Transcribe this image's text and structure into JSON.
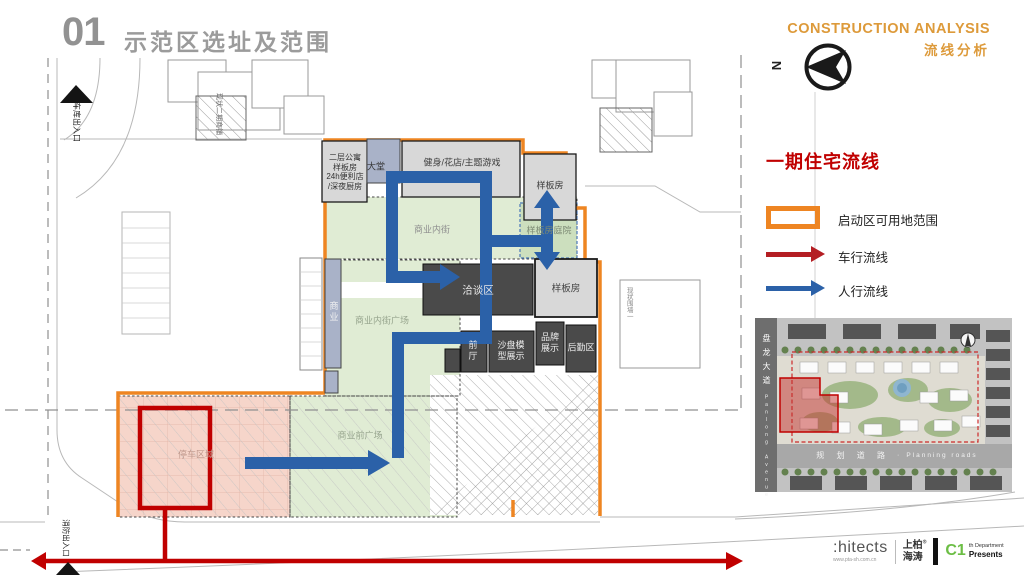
{
  "slide": {
    "number": "01",
    "title": "示范区选址及范围"
  },
  "header": {
    "en_title": "CONSTRUCTION ANALYSIS",
    "cn_subtitle": "流线分析",
    "compass_n": "N"
  },
  "legend": {
    "title": "一期住宅流线",
    "items": [
      {
        "label": "启动区可用地范围"
      },
      {
        "label": "车行流线"
      },
      {
        "label": "人行流线"
      }
    ]
  },
  "plan": {
    "buildings": {
      "apartment_block": "二层公寓\n样板房\n24h便利店\n/深夜厨房",
      "lobby": "大堂",
      "gym": "健身/花店/主题游戏",
      "sample_room_top": "样板房",
      "sample_courtyard": "样板房庭院",
      "sample_room_right": "样板房",
      "negotiation": "洽谈区",
      "front_hall": "前\n厅",
      "sand_table": "沙盘模\n型展示",
      "brand_display": "品牌\n展示",
      "logistics": "后勤区",
      "commerce": "商业"
    },
    "areas": {
      "inner_street": "商业内街",
      "inner_street_plaza": "商业内街广场",
      "front_plaza": "商业前广场",
      "parking": "停车区域"
    },
    "annotations": {
      "garage_entrance": "车库出入口",
      "fire_entrance": "消防出入口",
      "neighbor_building": "现状二期商铺",
      "fence_note": "现状围墙一"
    }
  },
  "minimap": {
    "road_left_cn": "盘龙大道",
    "road_left_en": "Panlong Avenue",
    "road_bottom_cn": "规 划 道 路",
    "separator": "·",
    "road_bottom_en": "Planning roads"
  },
  "footer": {
    "logo_text": ":hitects",
    "logo_url": "www.pta-sh.com.cn",
    "brand_top": "上柏",
    "brand_bottom": "海涛",
    "reg": "®",
    "dept_code": "C1",
    "dept_sup": "th",
    "dept_word": "Department",
    "presents": "Presents"
  },
  "colors": {
    "accent_orange": "#ee8522",
    "header_orange": "#dd9a3a",
    "flow_red": "#c00000",
    "flow_blue": "#2b61a8",
    "green_fill": "#e0ecd4",
    "pink_fill": "#f6d5ca",
    "dark_building": "#4a4a4a",
    "light_building": "#d8d8d8",
    "bluegray_building": "#a9b2c8"
  }
}
